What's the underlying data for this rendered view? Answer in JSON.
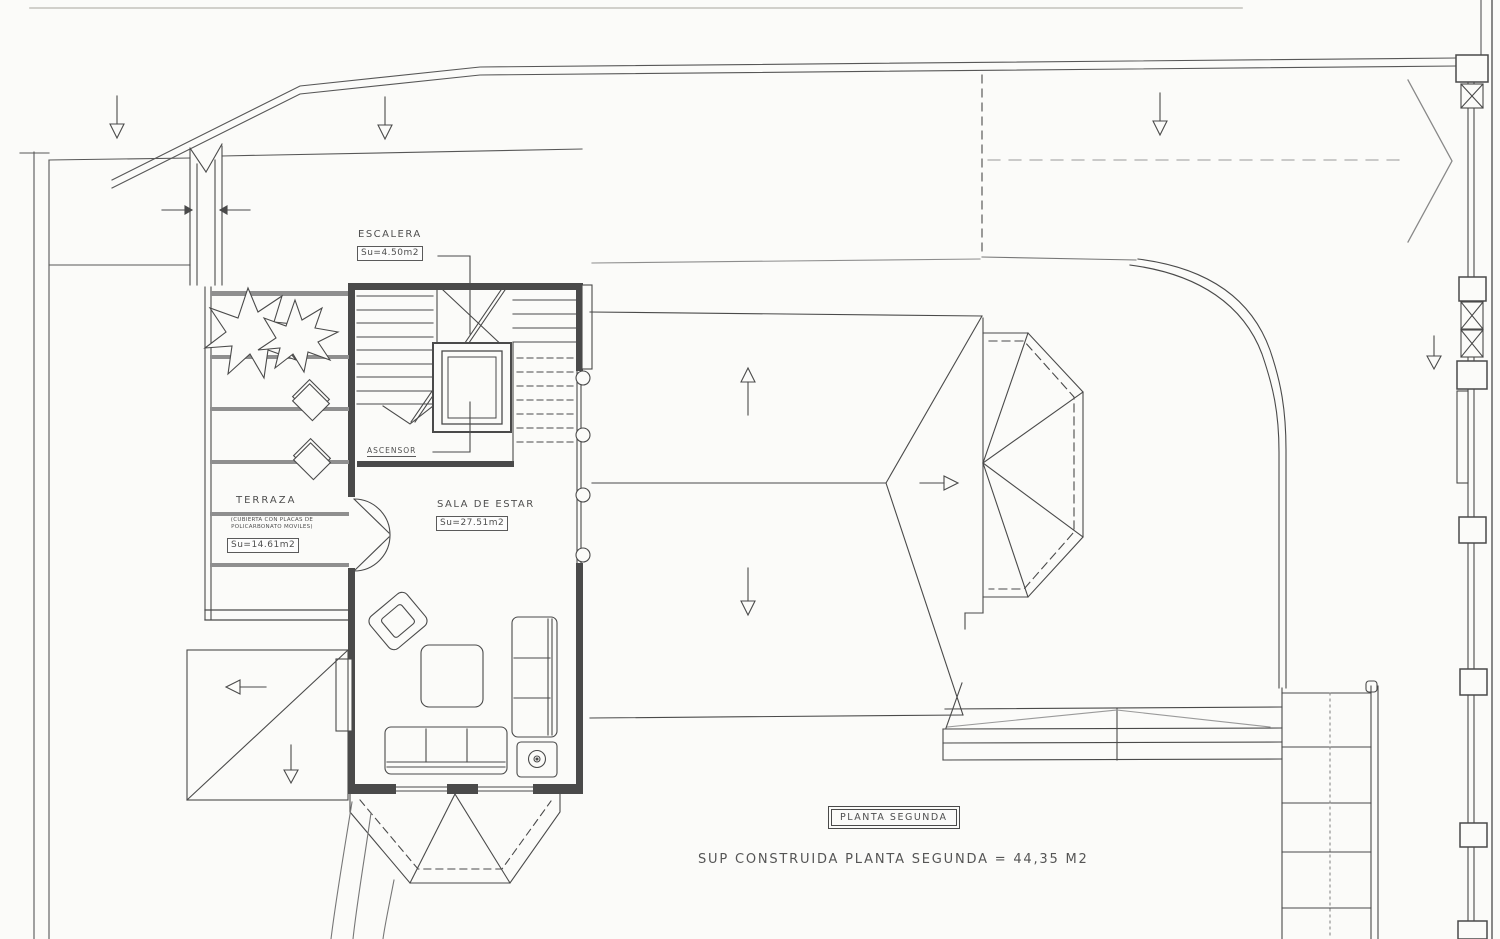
{
  "drawing": {
    "type": "architectural-floor-plan",
    "floor_title": "PLANTA SEGUNDA",
    "built_area_line": "SUP CONSTRUIDA PLANTA SEGUNDA = 44,35 M2"
  },
  "rooms": {
    "escalera": {
      "name": "ESCALERA",
      "area": "Su=4.50m2"
    },
    "ascensor": {
      "name": "ASCENSOR"
    },
    "terraza": {
      "name": "TERRAZA",
      "note_line1": "(CUBIERTA CON PLACAS DE",
      "note_line2": "POLICARBONATO MOVILES)",
      "area": "Su=14.61m2"
    },
    "sala_de_estar": {
      "name": "SALA DE ESTAR",
      "area": "Su=27.51m2"
    }
  },
  "colors": {
    "line": "#4a4a4a",
    "light_line": "#9a9a9a",
    "background": "#fbfbf9"
  }
}
